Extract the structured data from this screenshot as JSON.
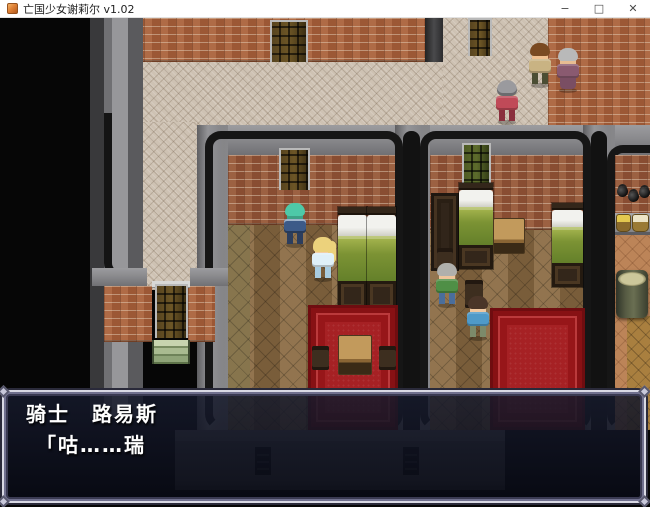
{
  "window": {
    "title": "亡国少女谢莉尔 v1.02",
    "controls": {
      "minimize": "−",
      "maximize": "□",
      "close": "✕"
    }
  },
  "dialogue": {
    "speaker": "骑士　路易斯",
    "line": "「咕……瑞"
  },
  "scene": {
    "npcs": [
      {
        "id": "villager-man-brown-hair",
        "hair": "#7a4a22",
        "outfit": "#c9b383"
      },
      {
        "id": "old-woman-gray-hair",
        "hair": "#b9b9b9",
        "outfit": "#8a5a70"
      },
      {
        "id": "knight-red-armor",
        "hair": "#9a9a9e",
        "outfit": "#c04a58"
      },
      {
        "id": "knight-teal-hair",
        "hair": "#4ec9a8",
        "outfit": "#3c5a88"
      },
      {
        "id": "girl-blonde",
        "hair": "#ecd27c",
        "outfit": "#dff0f8"
      },
      {
        "id": "man-green-shirt",
        "hair": "#b0b0ac",
        "outfit": "#4f8f46"
      },
      {
        "id": "boy-blue-shirt",
        "hair": "#4a3528",
        "outfit": "#4f9ac8"
      }
    ],
    "colors": {
      "street": "#cec2b3",
      "brick_wall": "#a4603c",
      "wall_top": "#8b8b8e",
      "parquet_floor": "#8a6a42",
      "bed_cover": "#7c9334",
      "carpet": "#a62124",
      "steps": "#a9bb90",
      "dialog_background": "#0c1020",
      "dialog_border": "#d9d9e4"
    }
  }
}
